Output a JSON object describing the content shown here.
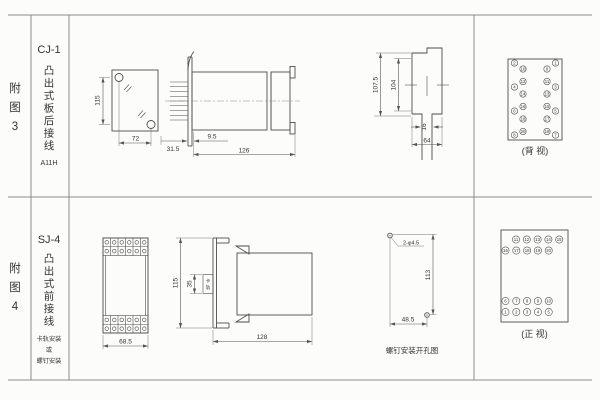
{
  "rows": [
    {
      "fig": "附图3",
      "model": "CJ-1",
      "type_vertical": "凸出式板后接线",
      "code": "A11H",
      "panel_view": {
        "height": "115",
        "width": "72"
      },
      "side_view": {
        "front_depth": "9.5",
        "pin_depth": "31.5",
        "total_depth": "126"
      },
      "cutout_view": {
        "outer_height": "107.5",
        "inner_height": "104",
        "slot": "16",
        "width": "64"
      },
      "terminal_view": {
        "caption": "(背 视)",
        "left_outer": [
          2,
          4,
          6,
          8
        ],
        "left_inner": [
          10,
          12,
          14,
          16,
          18,
          20
        ],
        "right_inner": [
          9,
          11,
          13,
          15,
          17,
          19
        ],
        "right_outer": [
          1,
          3,
          5,
          7
        ]
      }
    },
    {
      "fig": "附图4",
      "model": "SJ-4",
      "type_vertical": "凸出式前接线",
      "mount_lines": [
        "卡轨安装",
        "或",
        "螺钉安装"
      ],
      "front_view": {
        "width": "68.5"
      },
      "side_view": {
        "height": "115",
        "rail_width": "35",
        "rail_label": "卡轨",
        "total_depth": "128"
      },
      "drill_view": {
        "holes": "2-φ4.5",
        "height": "113",
        "width": "48.5",
        "caption": "螺钉安装开孔图"
      },
      "terminal_view": {
        "caption": "(正 视)",
        "rows": [
          [
            11,
            12,
            13,
            14,
            15
          ],
          [
            16,
            17,
            18,
            19,
            20
          ],
          [
            6,
            7,
            8,
            9,
            10
          ],
          [
            1,
            2,
            3,
            4,
            5
          ]
        ]
      }
    }
  ]
}
